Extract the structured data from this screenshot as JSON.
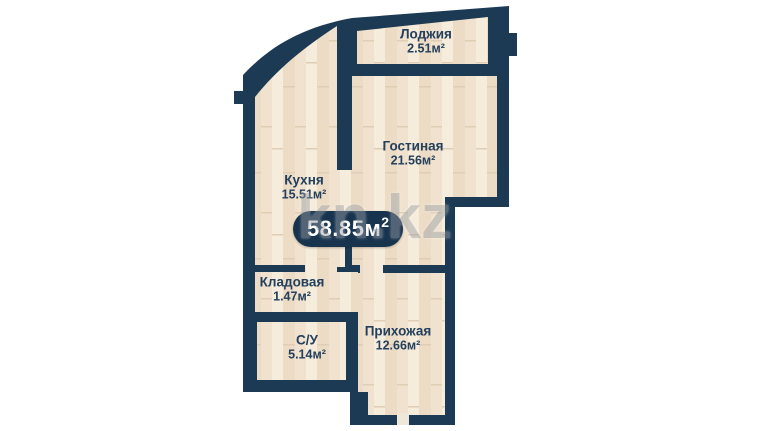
{
  "image": {
    "width": 765,
    "height": 431,
    "background": "#ffffff"
  },
  "floorplan": {
    "type": "apartment-floor-plan",
    "watermark": "kn.kz",
    "badge": {
      "value": "58.85м",
      "sup": "2"
    },
    "colors": {
      "wall": "#1d3a54",
      "label_text": "#24405c",
      "badge_bg": "#17334d",
      "badge_text": "#ffffff",
      "watermark_color": "#9aa0a6",
      "floor_base": "#f2e4d1",
      "floor_stripe_light": "#f6ecdc",
      "floor_stripe_dark": "#ecdcc6",
      "floor_mid": "#f0e2ce",
      "floor_seam": "#dfcdb4",
      "door_gap": "#efe7da"
    },
    "rooms": [
      {
        "id": "loggia",
        "name": "Лоджия",
        "area": "2.51м²"
      },
      {
        "id": "living",
        "name": "Гостиная",
        "area": "21.56м²"
      },
      {
        "id": "kitchen",
        "name": "Кухня",
        "area": "15.51м²"
      },
      {
        "id": "storage",
        "name": "Кладовая",
        "area": "1.47м²"
      },
      {
        "id": "bathroom",
        "name": "С/У",
        "area": "5.14м²"
      },
      {
        "id": "hallway",
        "name": "Прихожая",
        "area": "12.66м²"
      }
    ]
  }
}
